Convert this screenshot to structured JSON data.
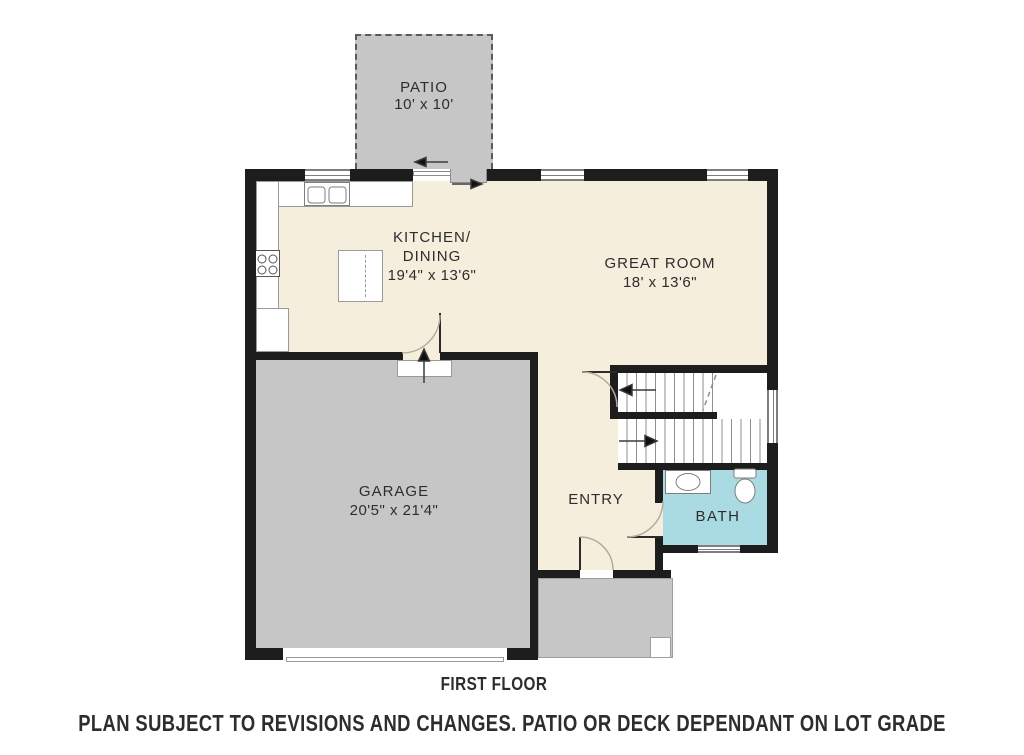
{
  "plan": {
    "title": "FIRST FLOOR",
    "disclaimer": "PLAN SUBJECT TO REVISIONS AND CHANGES. PATIO OR DECK DEPENDANT ON LOT GRADE",
    "rooms": {
      "patio": {
        "name": "PATIO",
        "dims": "10' x 10'"
      },
      "kitchen": {
        "line1": "KITCHEN/",
        "line2": "DINING",
        "dims": "19'4\" x 13'6\""
      },
      "great_room": {
        "name": "GREAT ROOM",
        "dims": "18' x 13'6\""
      },
      "garage": {
        "name": "GARAGE",
        "dims": "20'5\" x 21'4\""
      },
      "entry": {
        "name": "ENTRY"
      },
      "bath": {
        "name": "BATH"
      }
    },
    "colors": {
      "floor": "#f6eedd",
      "concrete": "#c6c6c6",
      "bath": "#abdbe2",
      "wall": "#1d1d1d",
      "line": "#8c8c8c",
      "text": "#2d2d2d"
    }
  }
}
